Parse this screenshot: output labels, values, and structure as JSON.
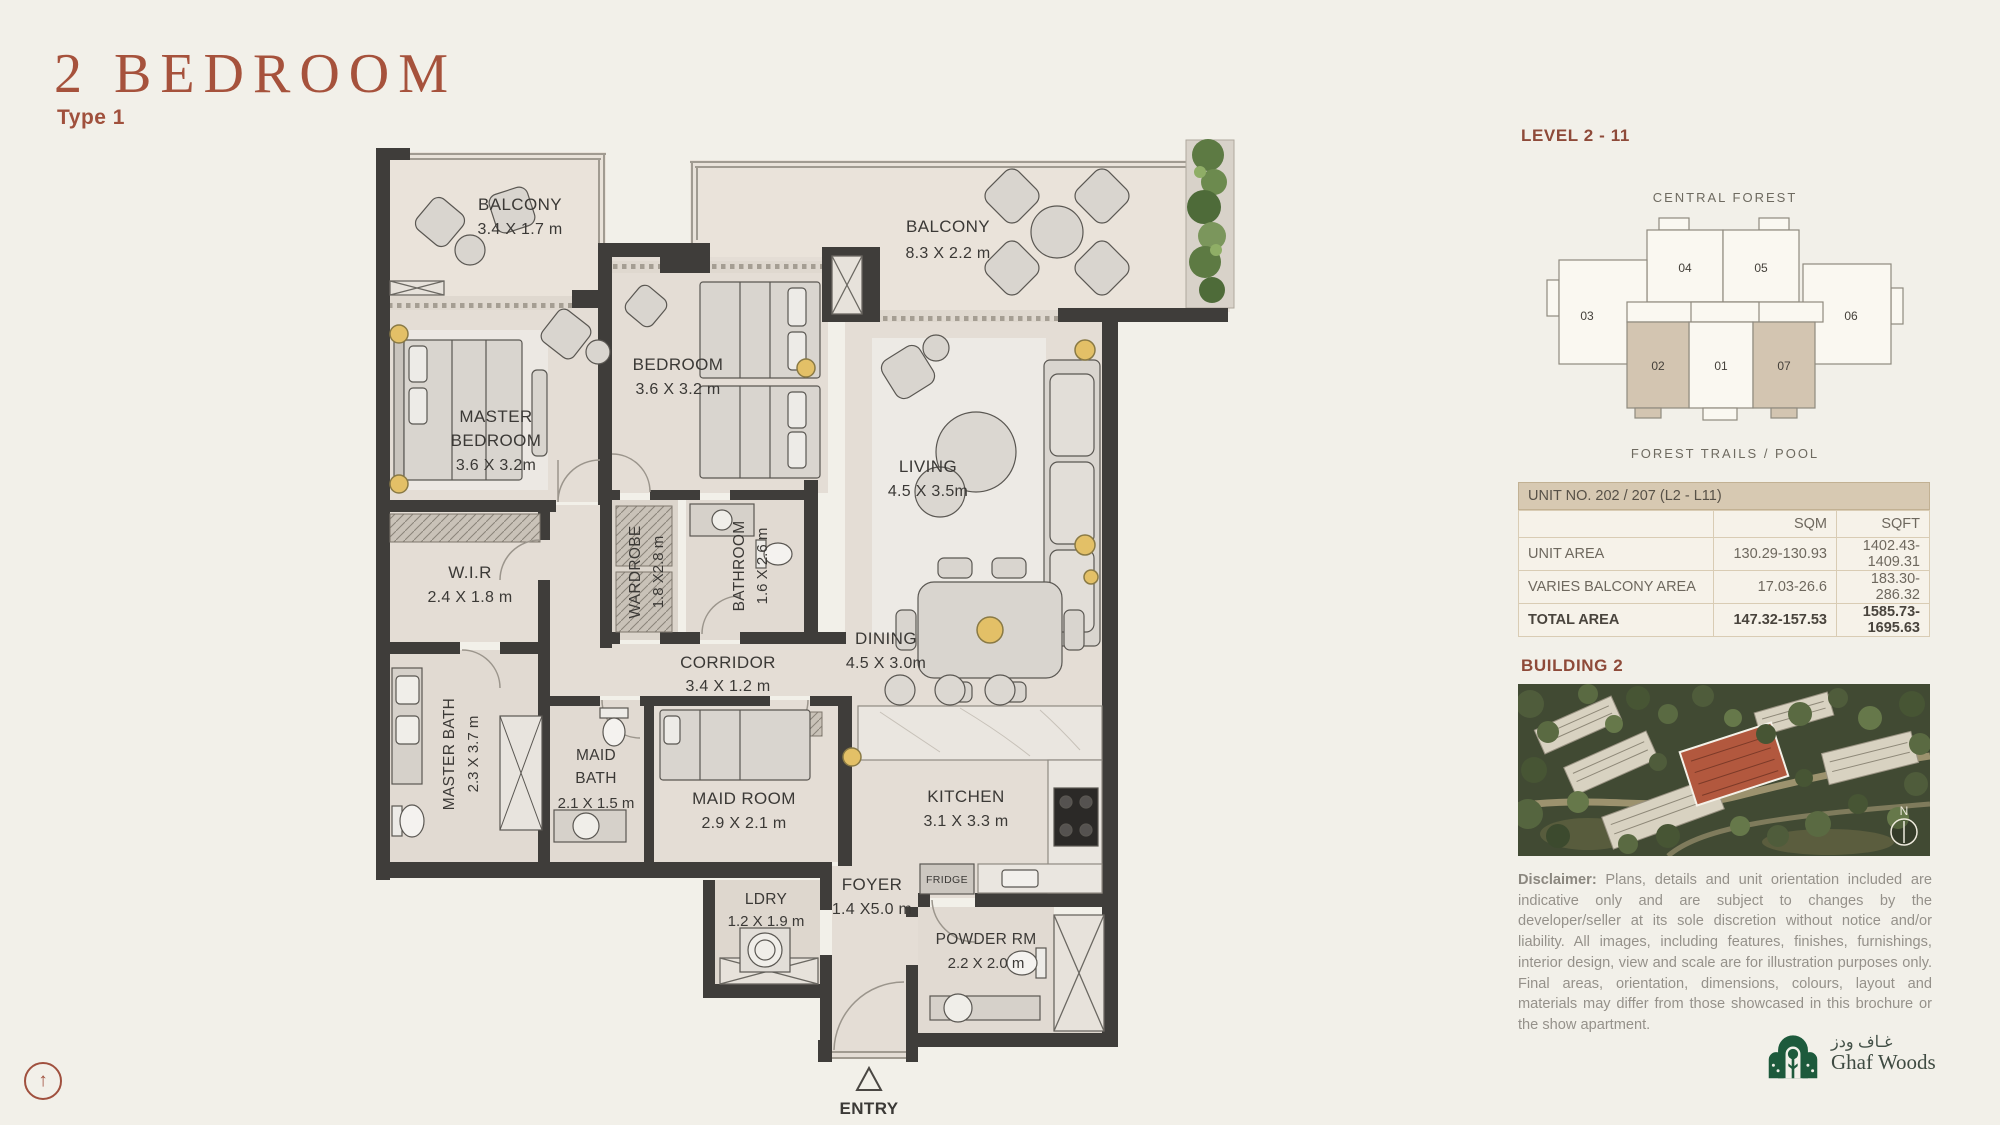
{
  "page": {
    "title": "2 BEDROOM",
    "subtitle": "Type 1"
  },
  "nav": {
    "back_to_top_icon": "circled-up-arrow"
  },
  "floor_plan": {
    "rooms": {
      "balcony_tl": [
        "BALCONY",
        "3.4 X 1.7 m"
      ],
      "balcony_tr": [
        "BALCONY",
        "8.3 X 2.2 m"
      ],
      "master_bedroom": [
        "MASTER",
        "BEDROOM",
        "3.6 X 3.2m"
      ],
      "bedroom": [
        "BEDROOM",
        "3.6 X 3.2 m"
      ],
      "wir": [
        "W.I.R",
        "2.4 X 1.8 m"
      ],
      "wardrobe": [
        "WARDROBE",
        "1.8 X2.8 m"
      ],
      "bathroom": [
        "BATHROOM",
        "1.6 X 2.6 m"
      ],
      "master_bath": [
        "MASTER BATH",
        "2.3 X 3.7 m"
      ],
      "corridor": [
        "CORRIDOR",
        "3.4 X 1.2 m"
      ],
      "living": [
        "LIVING",
        "4.5 X 3.5m"
      ],
      "dining": [
        "DINING",
        "4.5 X 3.0m"
      ],
      "kitchen": [
        "KITCHEN",
        "3.1 X 3.3 m"
      ],
      "maid_bath": [
        "MAID",
        "BATH",
        "2.1 X 1.5 m"
      ],
      "maid_room": [
        "MAID ROOM",
        "2.9 X 2.1 m"
      ],
      "ldry": [
        "LDRY",
        "1.2 X 1.9 m"
      ],
      "foyer": [
        "FOYER",
        "1.4 X5.0 m"
      ],
      "powder_rm": [
        "POWDER RM",
        "2.2 X 2.0 m"
      ],
      "fridge": "FRIDGE",
      "entry": "ENTRY"
    }
  },
  "key_plan": {
    "level": "LEVEL  2 - 11",
    "top_label": "CENTRAL FOREST",
    "bottom_label": "FOREST TRAILS / POOL",
    "units": {
      "u01": "01",
      "u02": "02",
      "u03": "03",
      "u04": "04",
      "u05": "05",
      "u06": "06",
      "u07": "07"
    },
    "highlighted_units": [
      "02",
      "07"
    ],
    "highlight_color": "#D3C5B1"
  },
  "area_table": {
    "header": "UNIT NO.  202 / 207 (L2 - L11)",
    "col_sqm": "SQM",
    "col_sqft": "SQFT",
    "rows": [
      {
        "label": "UNIT AREA",
        "sqm": "130.29-130.93",
        "sqft": "1402.43-1409.31"
      },
      {
        "label": "VARIES BALCONY AREA",
        "sqm": "17.03-26.6",
        "sqft": "183.30-286.32"
      },
      {
        "label": "TOTAL AREA",
        "sqm": "147.32-157.53",
        "sqft": "1585.73-1695.63"
      }
    ]
  },
  "building": {
    "heading": "BUILDING 2",
    "compass": "N",
    "highlight_color": "#B2583E"
  },
  "disclaimer": {
    "label": "Disclaimer:",
    "text": " Plans, details and unit orientation included are indicative only and are subject to changes by the developer/seller at its sole discretion without notice and/or liability. All images, including features, finishes, furnishings, interior design, view and scale are for illustration purposes only. Final areas, orientation, dimensions, colours, layout and materials may differ from those showcased in this brochure or the show apartment."
  },
  "logo": {
    "arabic": "غـاف ودز",
    "english": "Ghaf Woods"
  },
  "colors": {
    "accent_rust": "#A6523C",
    "heading_rust": "#8E4A39",
    "wall": "#3F3D3A",
    "table_header_bg": "#D7C9B2"
  }
}
